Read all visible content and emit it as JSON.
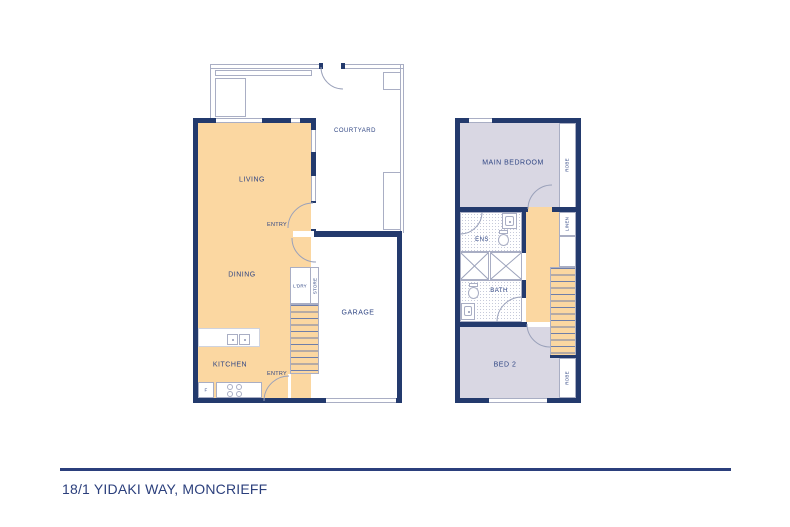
{
  "address": "18/1 YIDAKI WAY, MONCRIEFF",
  "colors": {
    "wall_navy": "#233a6d",
    "text_navy": "#2f4583",
    "floor_orange": "#fbd7a1",
    "floor_lavender": "#d9d7e3",
    "thin_line_gray": "#a9aec4",
    "rule_navy": "#2b3f7c"
  },
  "ground": {
    "courtyard": "COURTYARD",
    "living": "LIVING",
    "entry_top": "ENTRY",
    "dining": "DINING",
    "ldry": "L'DRY",
    "store": "STORE",
    "garage": "GARAGE",
    "kitchen": "KITCHEN",
    "entry_bottom": "ENTRY",
    "fridge": "F"
  },
  "upper": {
    "main_bedroom": "MAIN BEDROOM",
    "robe_top": "ROBE",
    "linen": "LINEN",
    "ens": "ENS",
    "bath": "BATH",
    "bed2": "BED 2",
    "robe_bottom": "ROBE"
  }
}
